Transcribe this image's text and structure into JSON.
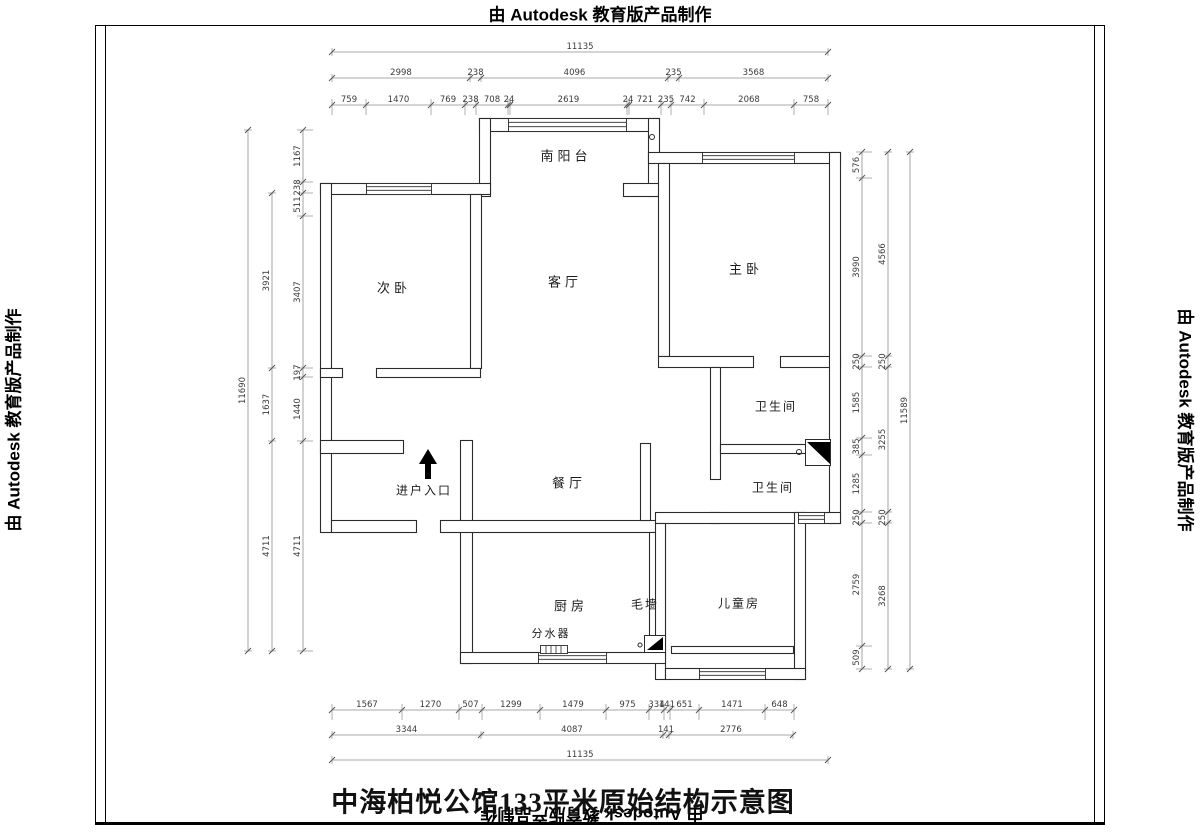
{
  "frame": {
    "stamp_top": "由 Autodesk 教育版产品制作",
    "stamp_bottom": "由 Autodesk 教育版产品制作",
    "stamp_left": "由 Autodesk 教育版产品制作",
    "stamp_right": "由 Autodesk 教育版产品制作"
  },
  "title": "中海柏悦公馆133平米原始结构示意图",
  "rooms": {
    "south_balcony": "南阳台",
    "secondary_bedroom": "次卧",
    "living_room": "客厅",
    "master_bedroom": "主卧",
    "bathroom_1": "卫生间",
    "bathroom_2": "卫生间",
    "dining_room": "餐厅",
    "entrance": "进户入口",
    "kitchen": "厨房",
    "rough_wall": "毛墙",
    "water_manifold": "分水器",
    "children_room": "儿童房"
  },
  "dimensions": {
    "top": [
      [
        "11135"
      ],
      [
        "2998",
        "238",
        "4096",
        "235",
        "3568"
      ],
      [
        "759",
        "1470",
        "769",
        "238",
        "708",
        "24",
        "2619",
        "24",
        "721",
        "235",
        "742",
        "2068",
        "758"
      ]
    ],
    "bottom": [
      [
        "1567",
        "1270",
        "507",
        "1299",
        "1479",
        "975",
        "334",
        "141",
        "651",
        "1471",
        "648"
      ],
      [
        "3344",
        "4087",
        "141",
        "2776"
      ],
      [
        "11135"
      ]
    ],
    "left": [
      [
        "11690"
      ],
      [
        "3921",
        "1637",
        "4711"
      ],
      [
        "1167",
        "238",
        "511",
        "3407",
        "197",
        "1440",
        "4711"
      ]
    ],
    "right": [
      [
        "576",
        "3990",
        "250",
        "1585",
        "385",
        "1285",
        "250",
        "2759",
        "509"
      ],
      [
        "4566",
        "250",
        "3255",
        "250",
        "3268"
      ],
      [
        "11589"
      ]
    ]
  }
}
